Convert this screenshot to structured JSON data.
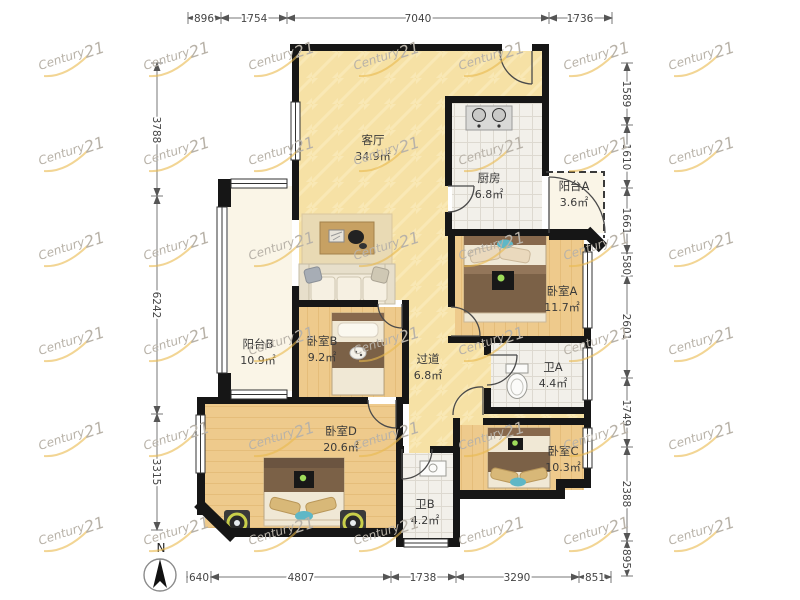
{
  "watermark": {
    "script": "Century",
    "number": "21"
  },
  "compass": {
    "label": "N"
  },
  "rooms": [
    {
      "id": "living",
      "name": "客厅",
      "area": "34.9㎡"
    },
    {
      "id": "kitchen",
      "name": "厨房",
      "area": "6.8㎡"
    },
    {
      "id": "balconyA",
      "name": "阳台A",
      "area": "3.6㎡"
    },
    {
      "id": "bedroomA",
      "name": "卧室A",
      "area": "11.7㎡"
    },
    {
      "id": "balconyB",
      "name": "阳台B",
      "area": "10.9㎡"
    },
    {
      "id": "bedroomB",
      "name": "卧室B",
      "area": "9.2㎡"
    },
    {
      "id": "hallway",
      "name": "过道",
      "area": "6.8㎡"
    },
    {
      "id": "bathA",
      "name": "卫A",
      "area": "4.4㎡"
    },
    {
      "id": "bedroomD",
      "name": "卧室D",
      "area": "20.6㎡"
    },
    {
      "id": "bathB",
      "name": "卫B",
      "area": "4.2㎡"
    },
    {
      "id": "bedroomC",
      "name": "卧室C",
      "area": "10.3㎡"
    }
  ],
  "dimensions": {
    "top": [
      "896",
      "1754",
      "7040",
      "1736"
    ],
    "bottom": [
      "640",
      "4807",
      "1738",
      "3290",
      "851"
    ],
    "left": [
      "3788",
      "6242",
      "3315"
    ],
    "right": [
      "1589",
      "1610",
      "1661",
      "580",
      "2601",
      "1749",
      "2388",
      "895"
    ]
  },
  "colors": {
    "wall": "#161616",
    "wood_floor": "#eeca8c",
    "tile_floor": "#f2f0ea",
    "living_floor": "#f6e1a5",
    "balcony_floor": "#faf5e7",
    "watermark_gray": "#b8b2a8",
    "watermark_gold": "#e9b94d"
  }
}
